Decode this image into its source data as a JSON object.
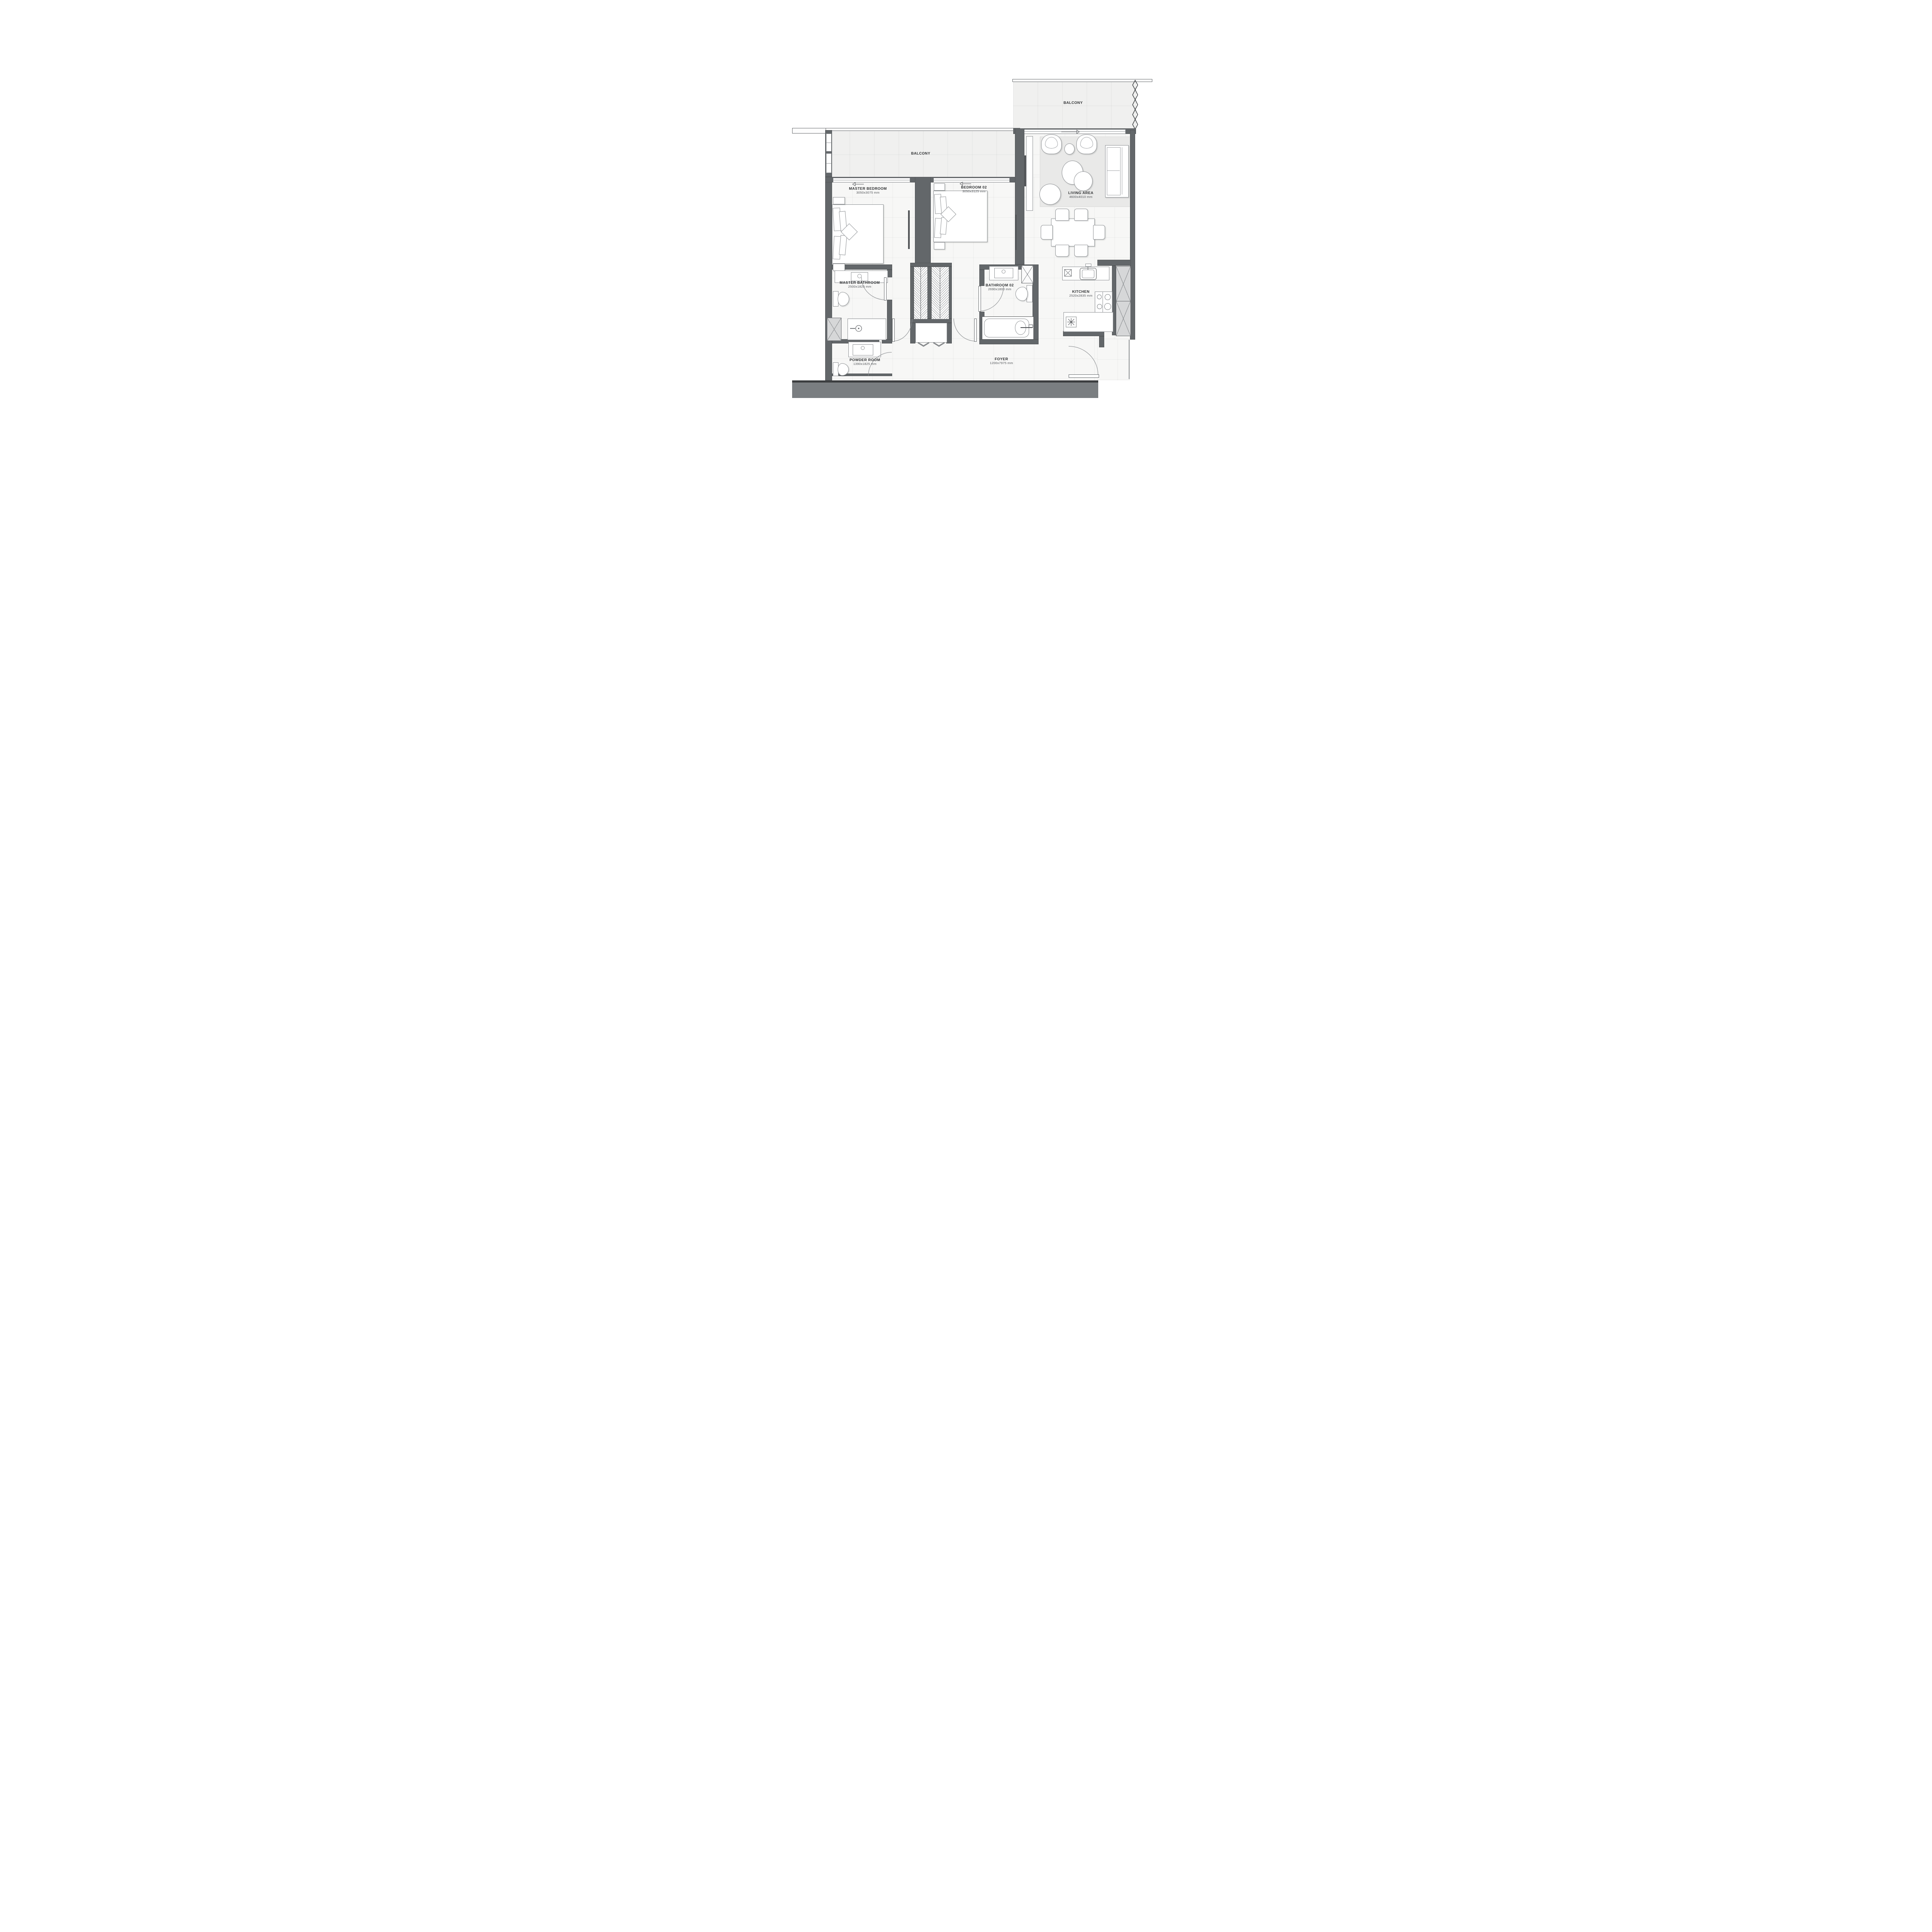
{
  "rooms": {
    "master_bedroom": {
      "name": "MASTER BEDROOM",
      "dims": "3050x3075 mm"
    },
    "bedroom_02": {
      "name": "BEDROOM 02",
      "dims": "3050x3125 mm"
    },
    "living_area": {
      "name": "LIVING AREA",
      "dims": "4600x4010 mm"
    },
    "master_bathroom": {
      "name": "MASTER BATHROOM",
      "dims": "2500x1825 mm"
    },
    "bathroom_02": {
      "name": "BATHROOM 02",
      "dims": "2690x1800 mm"
    },
    "kitchen": {
      "name": "KITCHEN",
      "dims": "2520x2835 mm"
    },
    "powder_room": {
      "name": "POWDER ROOM",
      "dims": "1390x1825 mm"
    },
    "foyer": {
      "name": "FOYER",
      "dims": "1200x7975 mm"
    },
    "balcony_main": {
      "name": "BALCONY"
    },
    "balcony_living": {
      "name": "BALCONY"
    }
  },
  "colors": {
    "wall": "#63676a",
    "structure_band": "#7a7e81",
    "floor": "#f7f7f6",
    "balcony_floor": "#f0f0ef",
    "rug": "#e9e9e8",
    "outline": "#94979a"
  }
}
